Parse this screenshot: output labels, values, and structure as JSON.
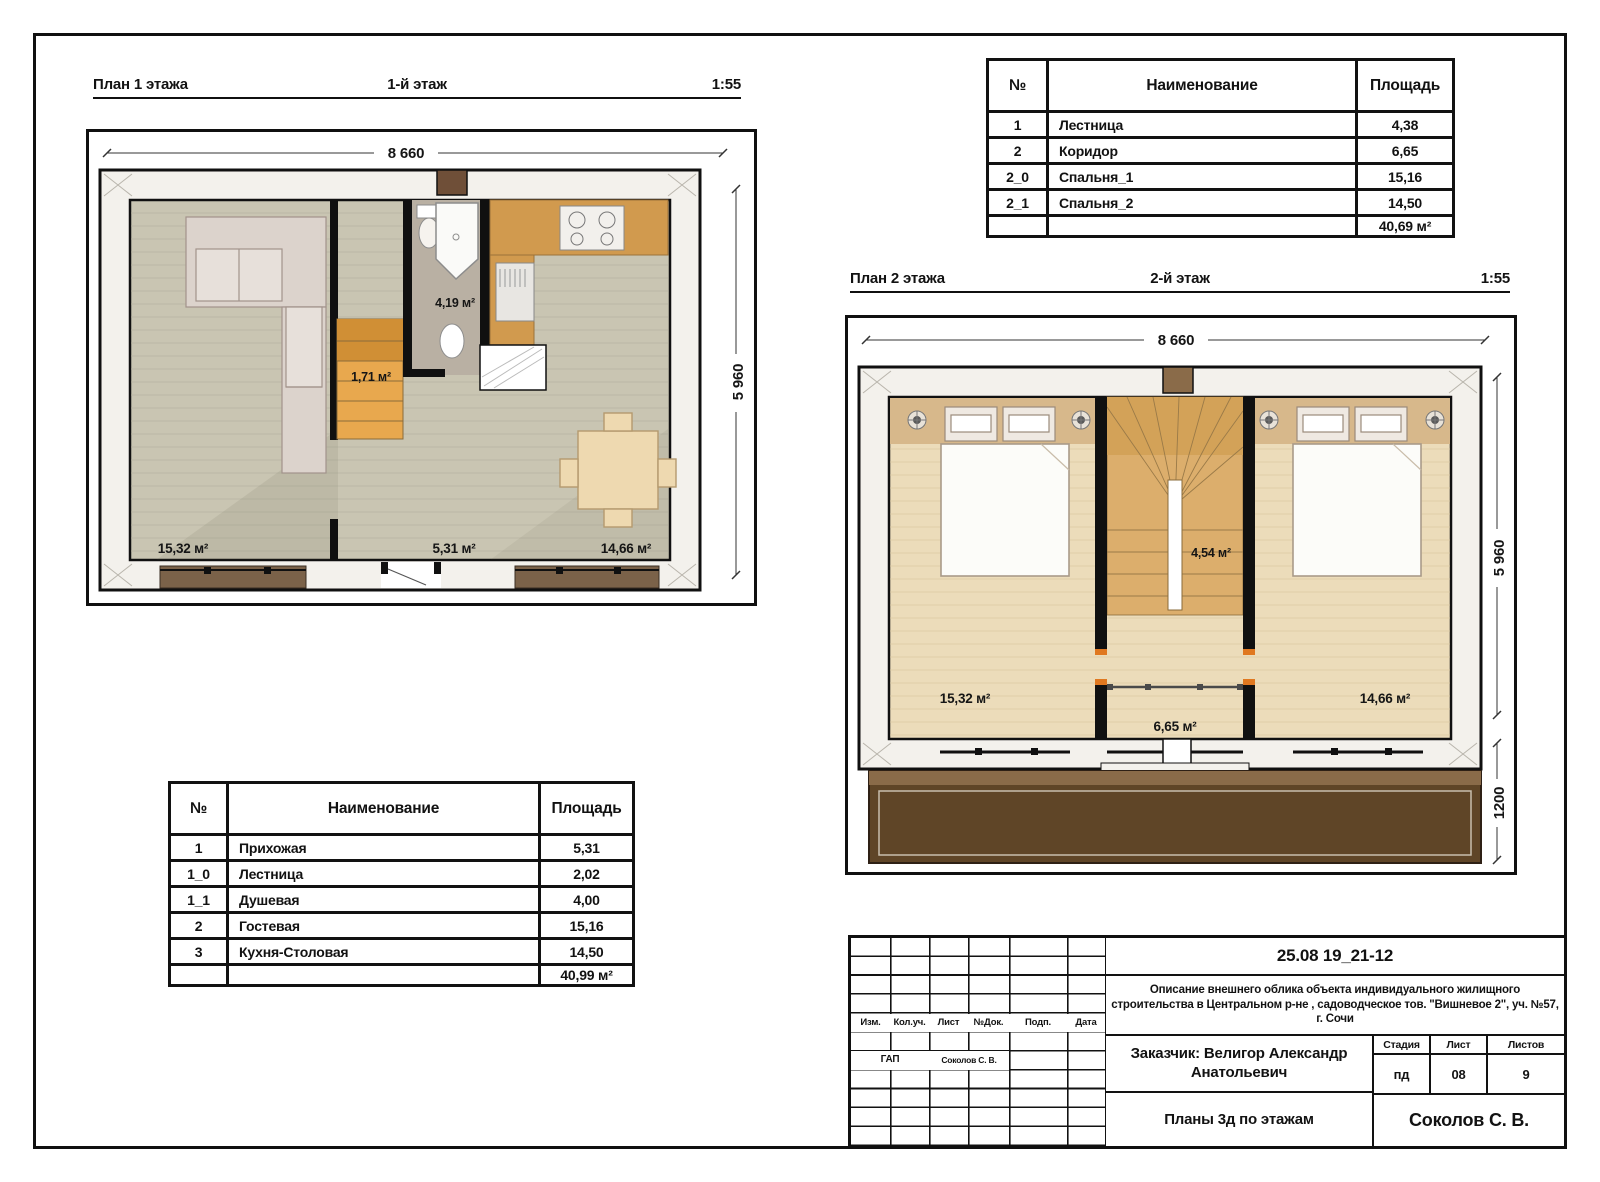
{
  "plan1": {
    "header": {
      "left": "План 1 этажа",
      "center": "1-й этаж",
      "scale": "1:55"
    },
    "dims": {
      "width": "8 660",
      "height": "5 960"
    },
    "areas": {
      "living": "15,32 м²",
      "hall": "5,31 м²",
      "kitchen_dining": "14,66 м²",
      "shower": "4,19 м²",
      "stairs": "1,71 м²"
    }
  },
  "plan2": {
    "header": {
      "left": "План 2 этажа",
      "center": "2-й этаж",
      "scale": "1:55"
    },
    "dims": {
      "width": "8 660",
      "height": "5 960",
      "balcony": "1200"
    },
    "areas": {
      "bedroom1": "15,32 м²",
      "corridor": "6,65 м²",
      "bedroom2": "14,66 м²",
      "stairs": "4,54 м²"
    }
  },
  "floor2_table": {
    "headers": {
      "num": "№",
      "name": "Наименование",
      "area": "Площадь"
    },
    "rows": [
      [
        "1",
        "Лестница",
        "4,38"
      ],
      [
        "2",
        "Коридор",
        "6,65"
      ],
      [
        "2_0",
        "Спальня_1",
        "15,16"
      ],
      [
        "2_1",
        "Спальня_2",
        "14,50"
      ]
    ],
    "total": "40,69 м²"
  },
  "floor1_table": {
    "headers": {
      "num": "№",
      "name": "Наименование",
      "area": "Площадь"
    },
    "rows": [
      [
        "1",
        "Прихожая",
        "5,31"
      ],
      [
        "1_0",
        "Лестница",
        "2,02"
      ],
      [
        "1_1",
        "Душевая",
        "4,00"
      ],
      [
        "2",
        "Гостевая",
        "15,16"
      ],
      [
        "3",
        "Кухня-Столовая",
        "14,50"
      ]
    ],
    "total": "40,99 м²"
  },
  "title_block": {
    "doc_number": "25.08 19_21-12",
    "description": "Описание внешнего облика объекта индивидуального жилищного строительства в  Центральном р-не , садоводческое тов. \"Вишневое 2\", уч. №57, г. Сочи",
    "columns": {
      "izm": "Изм.",
      "koluch": "Кол.уч.",
      "list": "Лист",
      "ndok": "№Док.",
      "podp": "Подп.",
      "data": "Дата"
    },
    "gap_role": "ГАП",
    "gap_name": "Соколов С. В.",
    "customer": "Заказчик: Велигор Александр Анатольевич",
    "stage": {
      "label": "Стадия",
      "value": "пд"
    },
    "sheet": {
      "label": "Лист",
      "value": "08"
    },
    "sheets": {
      "label": "Листов",
      "value": "9"
    },
    "drawing_title": "Планы 3д по этажам",
    "author": "Соколов С. В."
  }
}
